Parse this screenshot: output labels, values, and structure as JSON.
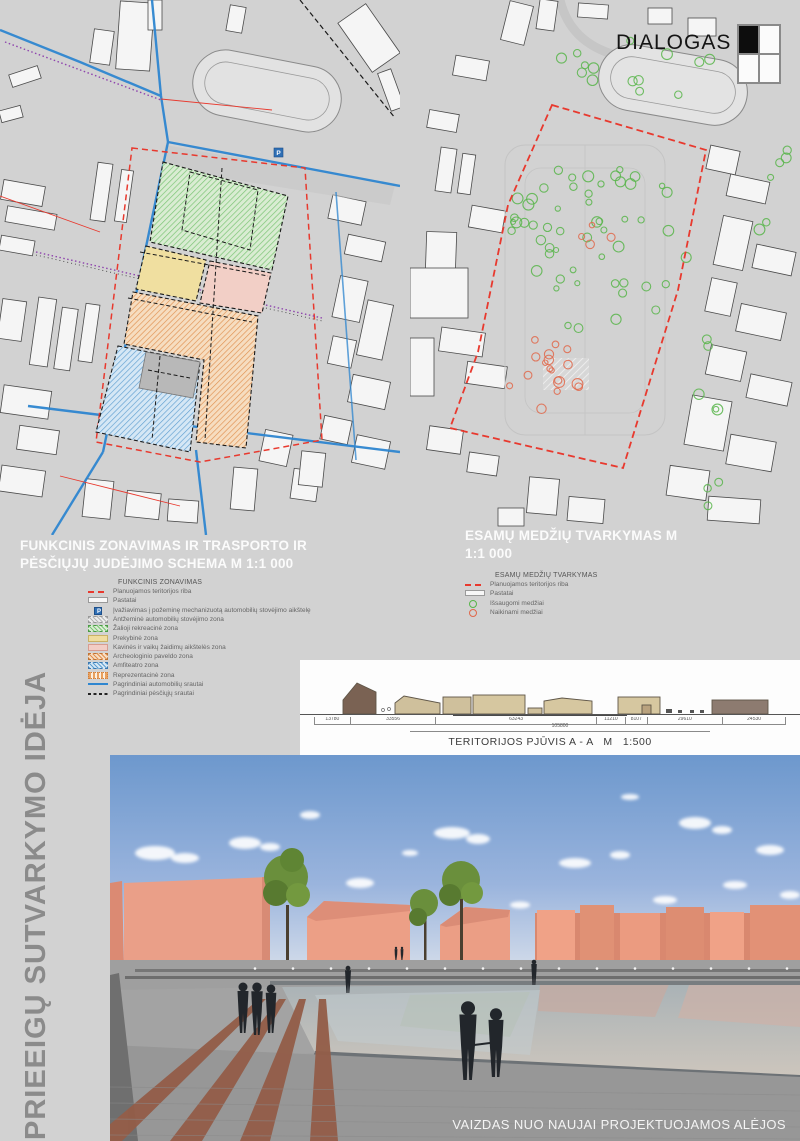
{
  "logo": {
    "text": "DIALOGAS"
  },
  "left_title": "PRIEEIGŲ SUTVARKYMO IDĖJA",
  "map1": {
    "title": "FUNKCINIS ZONAVIMAS IR TRASPORTO IR PĖSČIŲJŲ JUDĖJIMO SCHEMA M 1:1 000",
    "legend_title": "FUNKCINIS ZONAVIMAS",
    "legend": [
      {
        "swatch": "sw-red-dash",
        "label": "Planuojamos teritorijos riba"
      },
      {
        "swatch": "sw-building",
        "label": "Pastatai"
      },
      {
        "swatch": "sw-entrance",
        "label": "Įvažiavimas į požeminę mechanizuotą automobilių stovėjimo aikštelę"
      },
      {
        "swatch": "sw-hatch-gray",
        "label": "Antžeminė automobilių stovėjimo zona"
      },
      {
        "swatch": "sw-hatch-green",
        "label": "Žalioji rekreacinė zona"
      },
      {
        "swatch": "sw-solid-yellow",
        "label": "Prekybinė zona"
      },
      {
        "swatch": "sw-solid-pink",
        "label": "Kavinės ir vaikų žaidimų aikštelės zona"
      },
      {
        "swatch": "sw-hatch-orange",
        "label": "Archeologinio paveldo zona"
      },
      {
        "swatch": "sw-hatch-blue",
        "label": "Amfiteatro zona"
      },
      {
        "swatch": "sw-dot-orange",
        "label": "Reprezentacinė zona"
      },
      {
        "swatch": "sw-line-blue",
        "label": "Pagrindiniai automobilių srautai"
      },
      {
        "swatch": "sw-dash-black",
        "label": "Pagrindiniai pėsčiųjų srautai"
      }
    ]
  },
  "map2": {
    "title": "ESAMŲ MEDŽIŲ TVARKYMAS M 1:1 000",
    "legend_title": "ESAMŲ MEDŽIŲ TVARKYMAS",
    "legend": [
      {
        "swatch": "sw-red-dash",
        "label": "Planuojamos teritorijos riba"
      },
      {
        "swatch": "sw-building",
        "label": "Pastatai"
      },
      {
        "swatch": "sw-tree-green",
        "label": "Išsaugomi medžiai"
      },
      {
        "swatch": "sw-tree-red",
        "label": "Naikinami medžiai"
      }
    ]
  },
  "section": {
    "caption": "TERITORIJOS PJŪVIS A - A   M   1:500",
    "dimensions": [
      "13780",
      "33556",
      "63243",
      "11210",
      "8107",
      "29610",
      "24530"
    ],
    "total_dimension": "105800"
  },
  "render": {
    "caption": "VAIZDAS NUO NAUJAI PROJEKTUOJAMOS ALĖJOS"
  },
  "colors": {
    "accent_red": "#e8392e",
    "road_blue": "#2e86d0",
    "pedestrian_purple": "#8e44ad",
    "zone_green": "#79c06e",
    "zone_yellow": "#f0dfa0",
    "zone_pink": "#f2cfc6",
    "zone_orange": "#e8a05e",
    "zone_blue": "#6fa8d6",
    "tree_keep": "#58b54a",
    "tree_remove": "#e0684b",
    "building_salmon": "#ea9f88"
  }
}
